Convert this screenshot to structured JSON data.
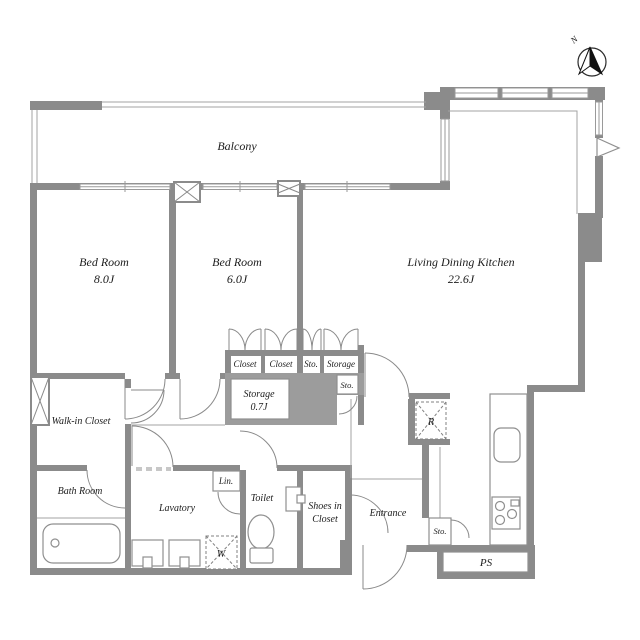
{
  "rooms": {
    "balcony": {
      "label": "Balcony"
    },
    "bedroom1": {
      "name": "Bed Room",
      "area": "8.0J"
    },
    "bedroom2": {
      "name": "Bed Room",
      "area": "6.0J"
    },
    "ldk": {
      "name": "Living Dining Kitchen",
      "area": "22.6J"
    },
    "walk_in_closet": {
      "label": "Walk-in Closet"
    },
    "bath": {
      "label": "Bath Room"
    },
    "lavatory": {
      "label": "Lavatory"
    },
    "toilet": {
      "label": "Toilet"
    },
    "shoes_in_closet": {
      "line1": "Shoes in",
      "line2": "Closet"
    },
    "entrance": {
      "label": "Entrance"
    },
    "pipe_space": {
      "label": "PS"
    }
  },
  "storage": {
    "closet1": {
      "label": "Closet"
    },
    "closet2": {
      "label": "Closet"
    },
    "sto_top": {
      "label": "Sto."
    },
    "storage_top": {
      "label": "Storage"
    },
    "storage07": {
      "name": "Storage",
      "area": "0.7J"
    },
    "sto_mid": {
      "label": "Sto."
    },
    "sto_entrance": {
      "label": "Sto."
    },
    "linen": {
      "label": "Lin."
    }
  },
  "appliances": {
    "washer": {
      "label": "W"
    },
    "refrigerator": {
      "label": "R"
    }
  },
  "compass": {
    "north": "N"
  },
  "colors": {
    "wall": "#8b8b8b",
    "shaded_area": "#9c9c9c",
    "line": "#9a9a9a",
    "text": "#1c1c1c",
    "background": "#ffffff"
  }
}
